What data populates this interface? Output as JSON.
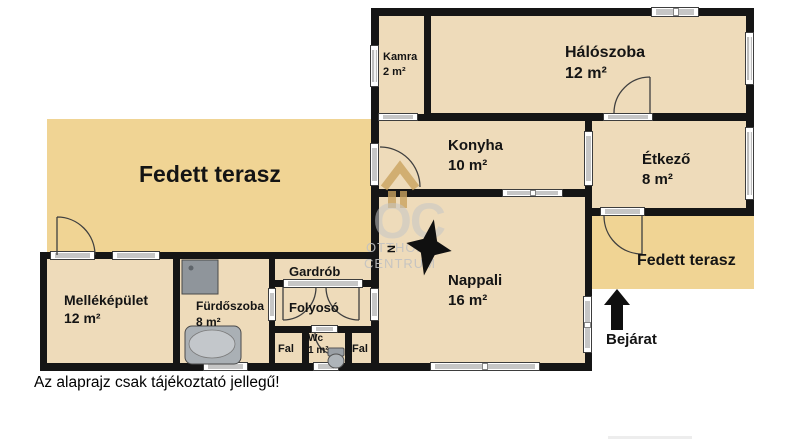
{
  "colors": {
    "terrace": "#f0d494",
    "room": "#eedbba",
    "wall": "#151515",
    "label": "#141414"
  },
  "rooms": {
    "terasz_left": {
      "name": "Fedett terasz"
    },
    "terasz_right": {
      "name": "Fedett terasz"
    },
    "kamra": {
      "name": "Kamra",
      "area": "2 m²"
    },
    "haloszoba": {
      "name": "Hálószoba",
      "area": "12 m²"
    },
    "konyha": {
      "name": "Konyha",
      "area": "10 m²"
    },
    "etkezo": {
      "name": "Étkező",
      "area": "8 m²"
    },
    "nappali": {
      "name": "Nappali",
      "area": "16 m²"
    },
    "mellekepulet": {
      "name": "Melléképület",
      "area": "12 m²"
    },
    "furdoszoba": {
      "name": "Fürdőszoba",
      "area": "8 m²"
    },
    "gardrob": {
      "name": "Gardrób"
    },
    "folyoso": {
      "name": "Folyosó"
    },
    "wc": {
      "name": "Wc",
      "area": "1 m²"
    },
    "fal_left": {
      "name": "Fal"
    },
    "fal_right": {
      "name": "Fal"
    }
  },
  "entrance": {
    "label": "Bejárat"
  },
  "compass": {
    "label": "N"
  },
  "watermark": {
    "monogram": "OC",
    "line1": "OTTHON",
    "line2": "CENTRUM"
  },
  "disclaimer": "Az alaprajz csak tájékoztató jellegű!"
}
